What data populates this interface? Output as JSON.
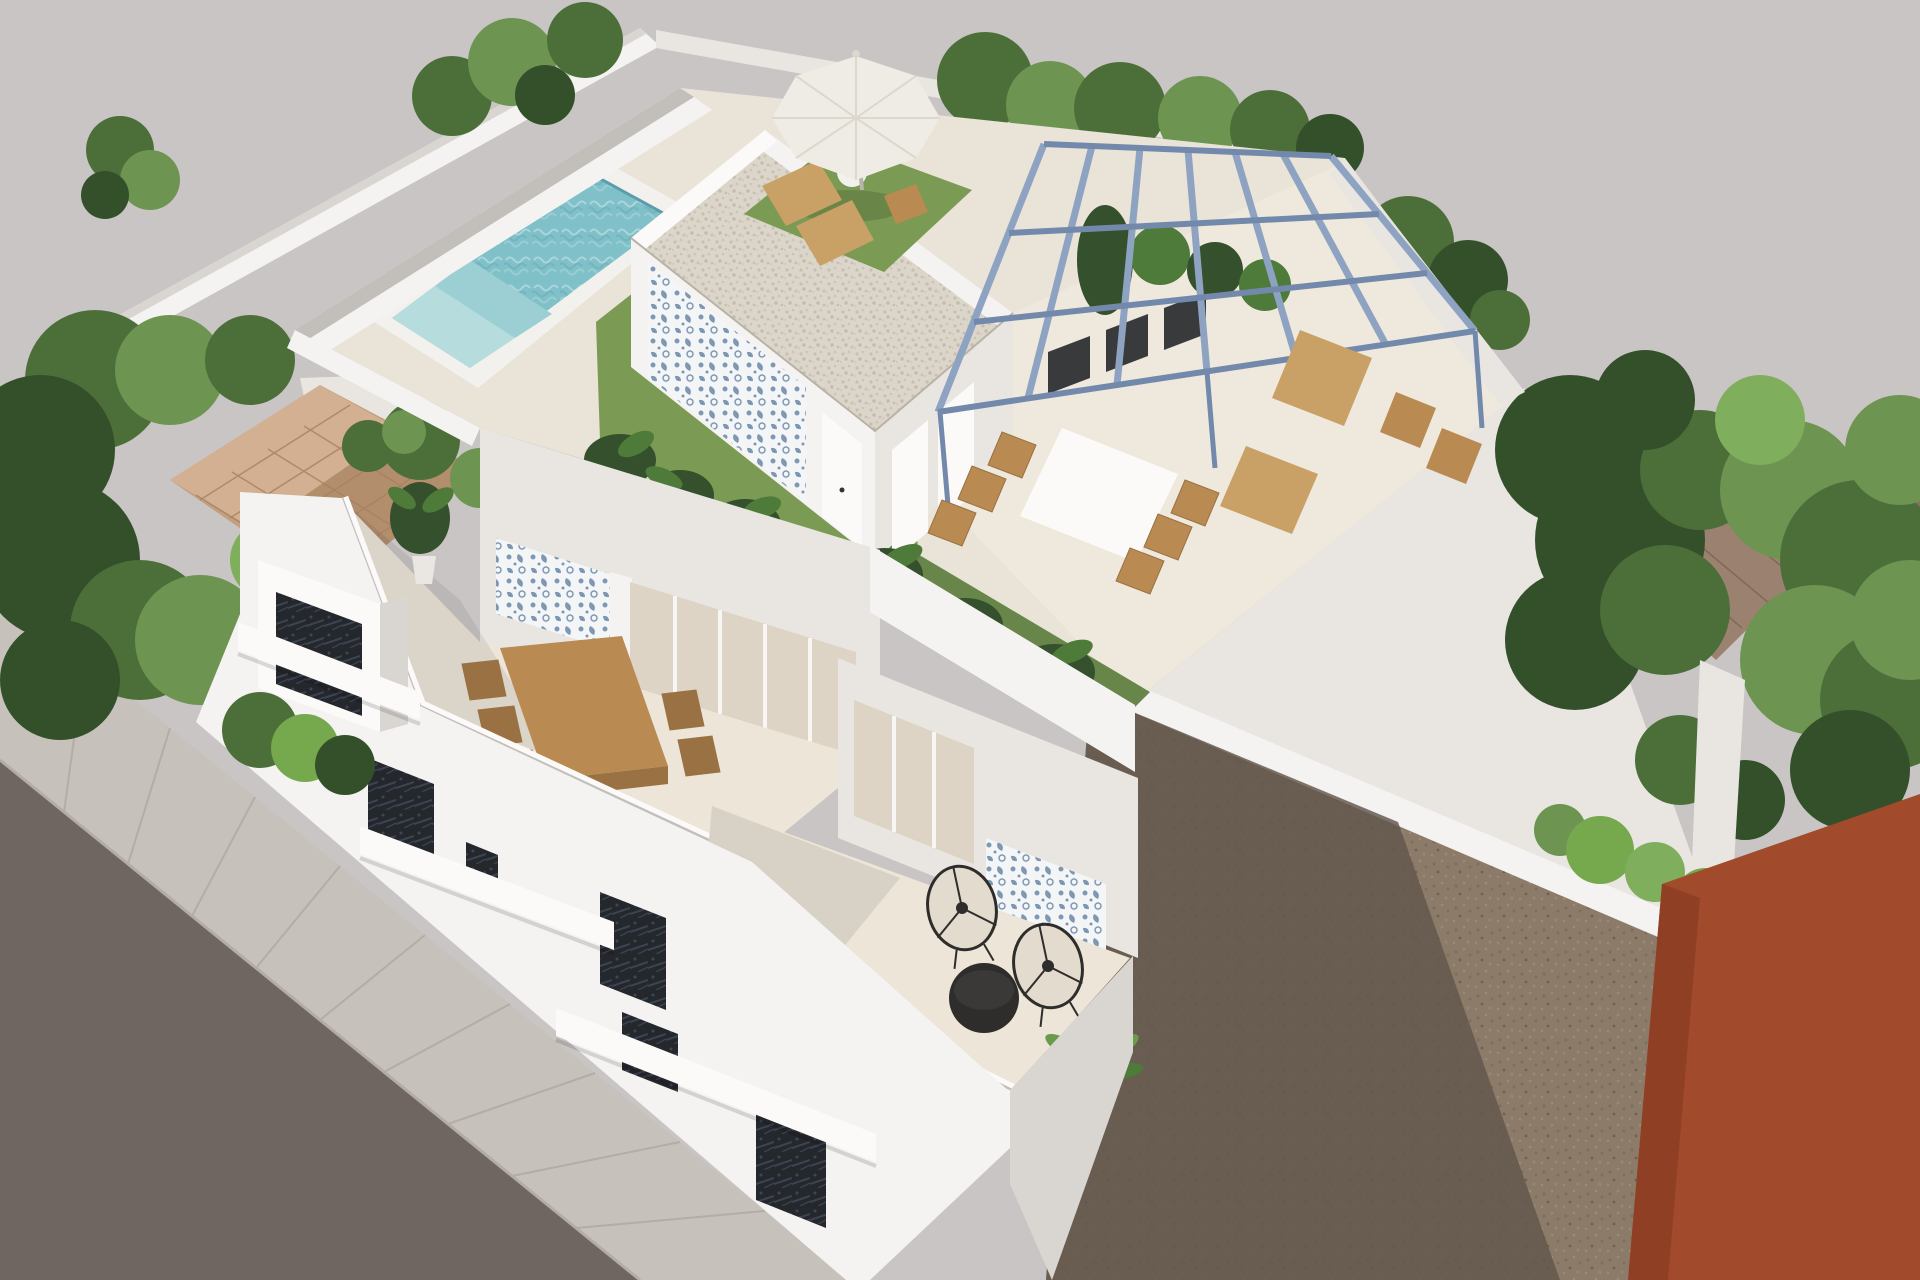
{
  "scene": {
    "description": "Aerial 3D architectural rendering of a modern white villa with rooftop swimming pool, parasol lounge, penthouse with gravel roof and blue patterned tile accent, steel pergola with outdoor furniture, two lower terraces, street facade with balconies, neighboring terracotta-roofed houses among trees, an empty dirt lot beside a rust-red building, and a tiled sidewalk along a dark road.",
    "elements": [
      "background-sky",
      "road",
      "sidewalk",
      "left-boundary-wall",
      "left-trees",
      "left-neighbor-terracotta-roof",
      "perimeter-bushes",
      "back-boundary-wall",
      "right-neighbor-roofs",
      "right-trees",
      "dirt-lot",
      "dirt-shadow",
      "garden-hedge",
      "red-building",
      "villa-roof-deck",
      "swimming-pool",
      "pool-coping",
      "deck-grass",
      "tropical-plants",
      "penthouse",
      "gravel-roof",
      "blue-tile-accent-wall",
      "penthouse-doors",
      "steel-pergola",
      "sun-loungers",
      "roof-dining-set",
      "parasol-umbrella",
      "upper-terrace",
      "wooden-dining-table",
      "potted-plant",
      "glass-doors",
      "lower-terrace",
      "wire-chairs",
      "round-coffee-table",
      "palm-plant",
      "street-facade",
      "balcony",
      "dark-windows",
      "railing-bands",
      "street-hedge"
    ]
  },
  "colors": {
    "bg": "#c9c5c4",
    "road": "#6f6661",
    "sidewalk": "#c6c1ba",
    "sidewalk_line": "#b3ada5",
    "wall_white": "#f4f3f1",
    "wall_bright": "#fbfaf8",
    "wall_mid": "#e9e6e2",
    "wall_shade": "#d9d6d2",
    "cap_gray": "#c2bfbb",
    "floor_deck": "#e9e3d8",
    "floor_light": "#efe9dd",
    "floor_terrace": "#ece5d8",
    "pool_water": "#7fc0c9",
    "pool_mid": "#9ccfd3",
    "pool_light": "#b7dcdd",
    "pool_dark": "#5c9dab",
    "coping": "#f2f1ee",
    "grass": "#7b9a54",
    "grass_dark": "#68864a",
    "plant_dark": "#35502c",
    "plant_mid": "#4e7a3a",
    "plant_light": "#6a9a4a",
    "tree_dark": "#33502b",
    "tree_mid": "#4c6f3a",
    "tree_light": "#6d9451",
    "tree_bright": "#7fae5c",
    "hedge": "#76a84e",
    "terracotta": "#c29f80",
    "terracotta_light": "#d2b091",
    "terracotta_dark": "#b28e6d",
    "terracotta_line": "#a8815f",
    "roof_right": "#9b8270",
    "roof_right_dark": "#8a7260",
    "roof_right_line": "#7c6452",
    "pergola": "#8ea3c2",
    "pergola_dark": "#7389ab",
    "gravel": "#dcd5ca",
    "gravel_dot": "#c7c0b2",
    "tile_blue": "#7e98b4",
    "tile_bg": "#f3f5f7",
    "wood": "#b98a52",
    "wood_dark": "#9a7142",
    "wood_light": "#c9a065",
    "umbrella": "#efece5",
    "umbrella_shade": "#ddd8cc",
    "black_furniture": "#2e2d2b",
    "window_dark": "#24272c",
    "window_speck": "#465060",
    "glass": "#ded4c5",
    "dirt": "#8d7b69",
    "dirt_shadow": "#61564b",
    "red_building": "#a14a2c",
    "red_dark": "#8f3f24"
  }
}
